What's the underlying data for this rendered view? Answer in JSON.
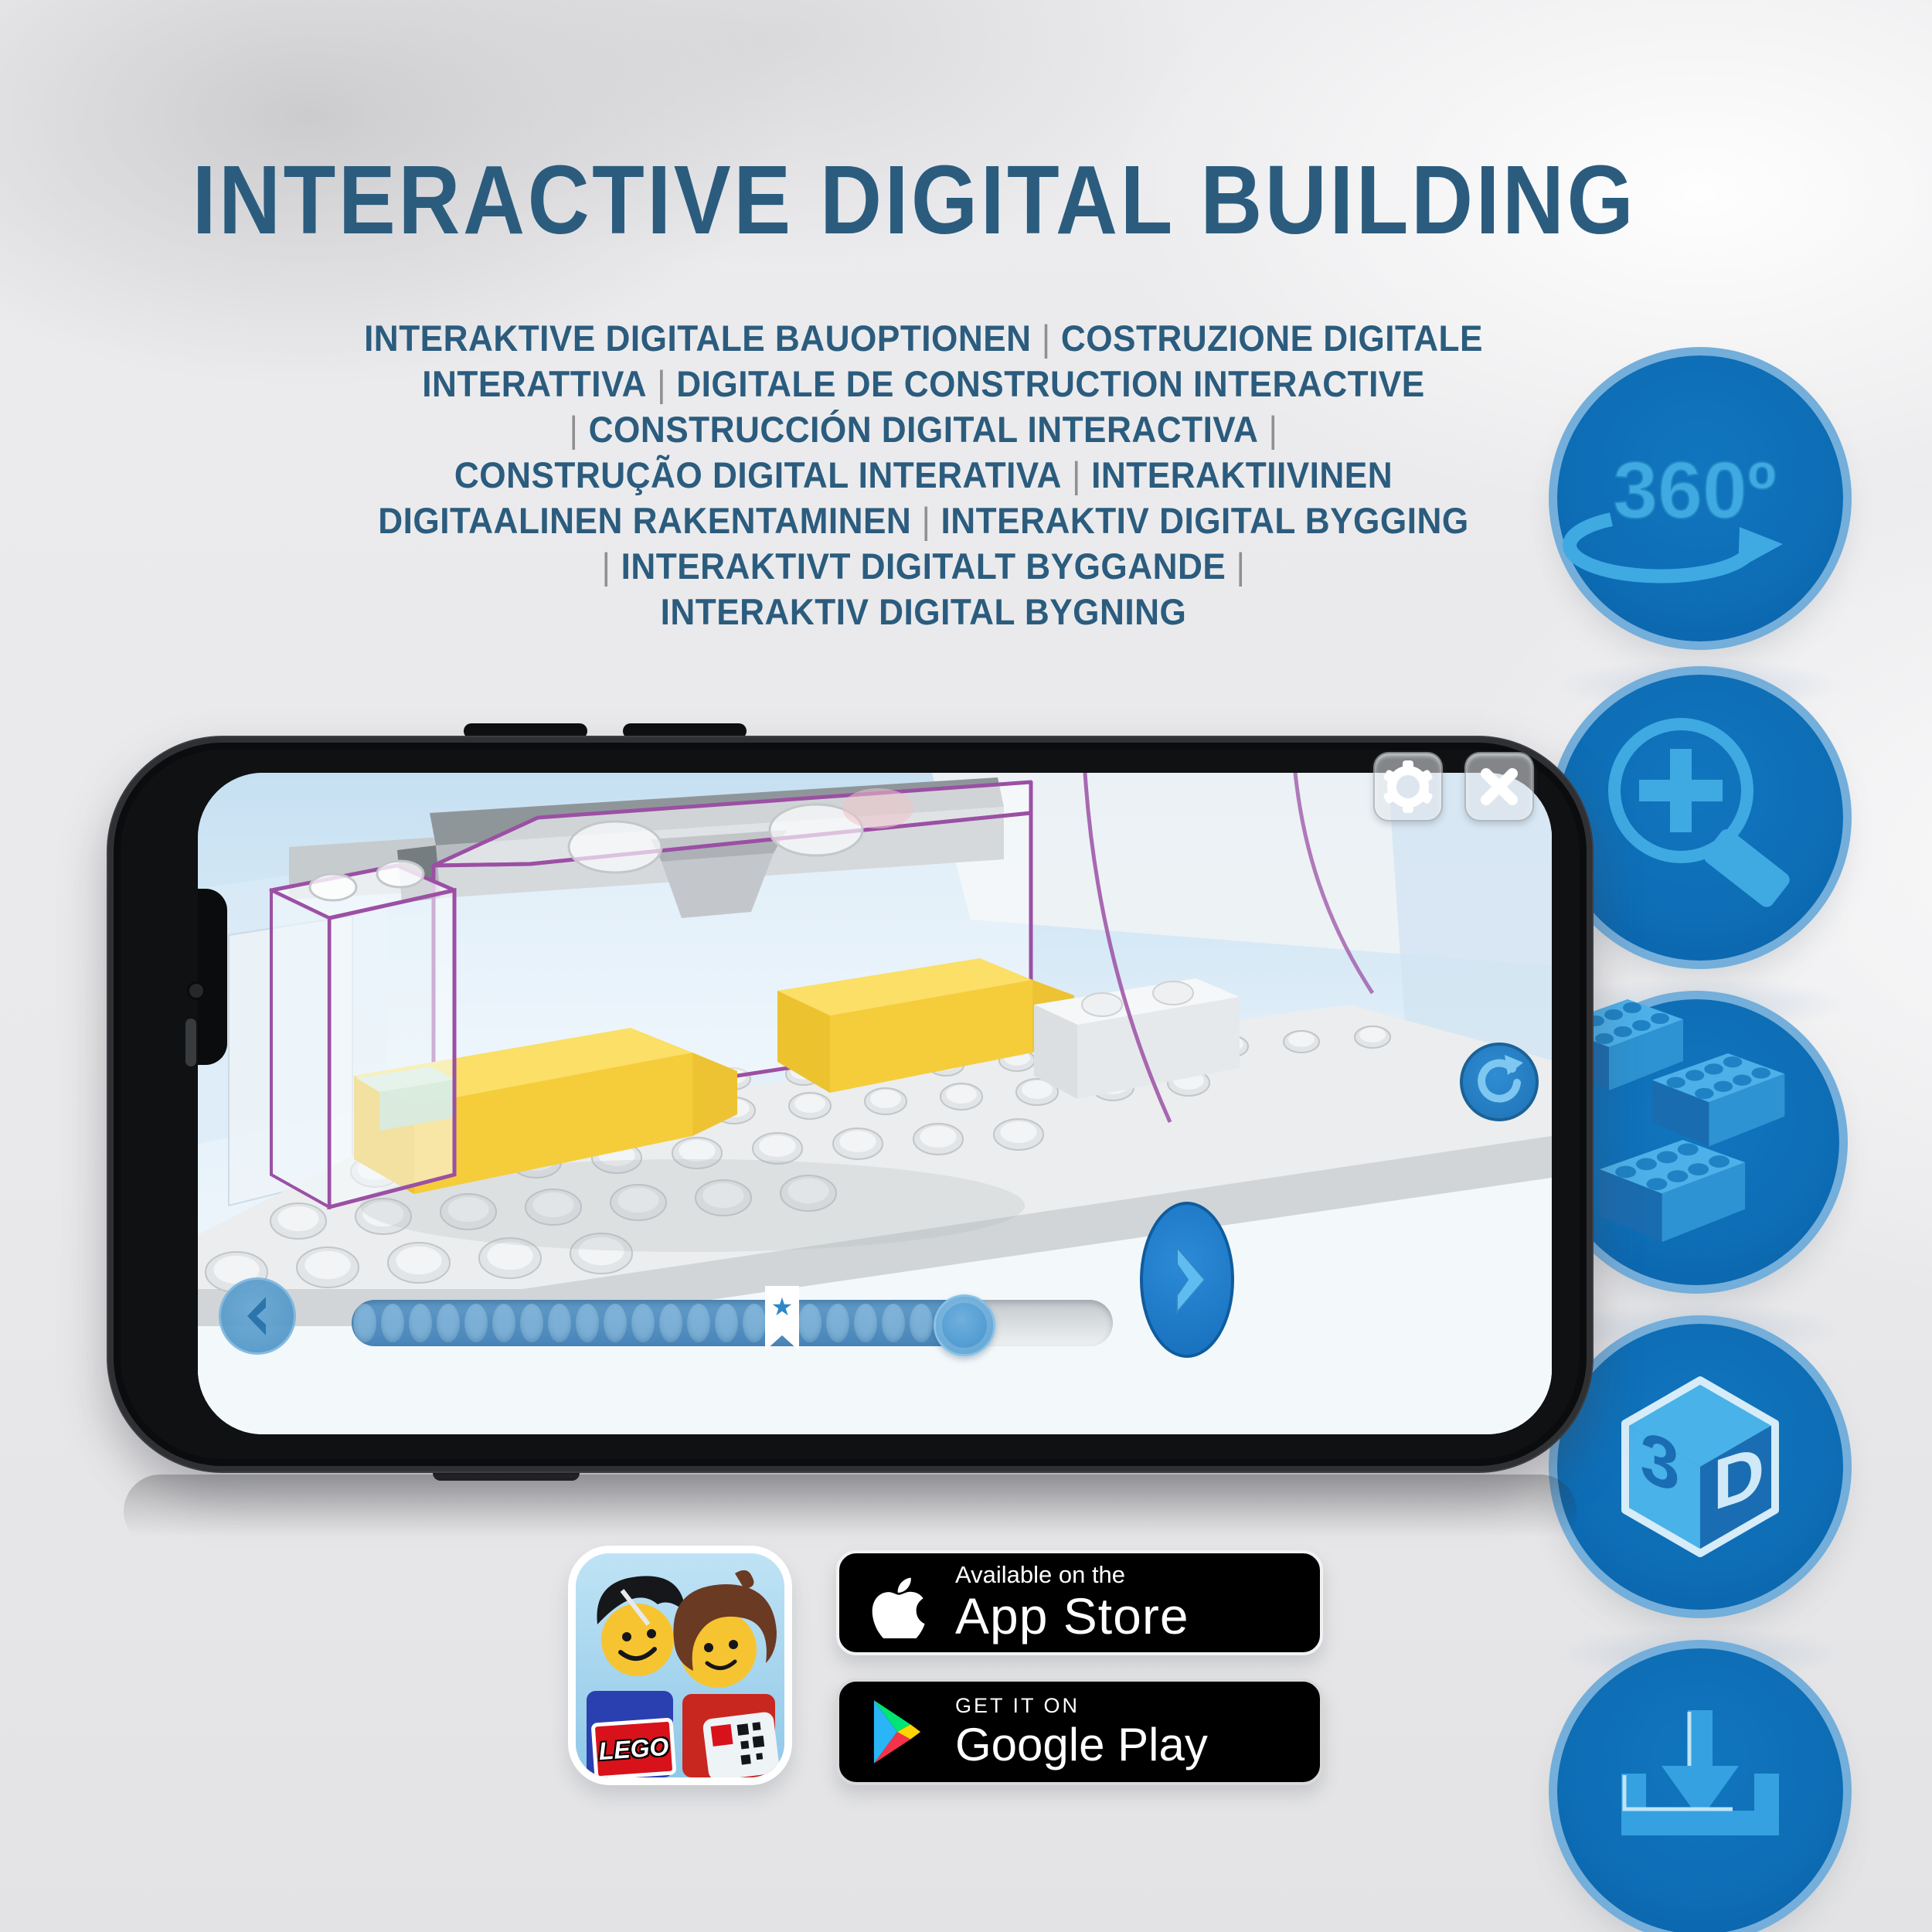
{
  "header": {
    "title": "INTERACTIVE DIGITAL BUILDING",
    "separator": "|",
    "subtitle_lines": [
      {
        "lead": false,
        "parts": [
          "INTERAKTIVE DIGITALE BAUOPTIONEN",
          "COSTRUZIONE DIGITALE"
        ],
        "trail": false
      },
      {
        "lead": false,
        "parts": [
          "INTERATTIVA",
          "DIGITALE DE CONSTRUCTION INTERACTIVE"
        ],
        "trail": false
      },
      {
        "lead": true,
        "parts": [
          "CONSTRUCCIÓN DIGITAL INTERACTIVA"
        ],
        "trail": true
      },
      {
        "lead": false,
        "parts": [
          "CONSTRUÇÃO DIGITAL INTERATIVA",
          "INTERAKTIIVINEN"
        ],
        "trail": false
      },
      {
        "lead": false,
        "parts": [
          "DIGITAALINEN RAKENTAMINEN",
          "INTERAKTIV DIGITAL BYGGING"
        ],
        "trail": false
      },
      {
        "lead": true,
        "parts": [
          "INTERAKTIVT DIGITALT BYGGANDE"
        ],
        "trail": true
      },
      {
        "lead": false,
        "parts": [
          "INTERAKTIV DIGITAL BYGNING"
        ],
        "trail": false
      }
    ]
  },
  "feature_icons": {
    "rotation_label": "360º",
    "cube_left": "3",
    "cube_right": "D"
  },
  "phone_app": {
    "progress": {
      "total_dots": 21,
      "bookmark_slot": 15,
      "star_glyph": "★"
    }
  },
  "badges": {
    "lego_app_logo": "LEGO",
    "app_store": {
      "line1": "Available on the",
      "line2": "App Store"
    },
    "google_play": {
      "line1": "GET IT ON",
      "line2": "Google Play"
    }
  },
  "colors": {
    "heading": "#2b5c7e",
    "separator_gray": "#8f9092",
    "icon_circle_fill": "#0d6eb5",
    "icon_circle_rim": "#74aeda",
    "icon_glyph_blue": "#3fa9e2",
    "app_accent_blue": "#2a85cc",
    "yellow_brick": "#f5cd3a",
    "ghost_outline_purple": "#9b50a4"
  }
}
